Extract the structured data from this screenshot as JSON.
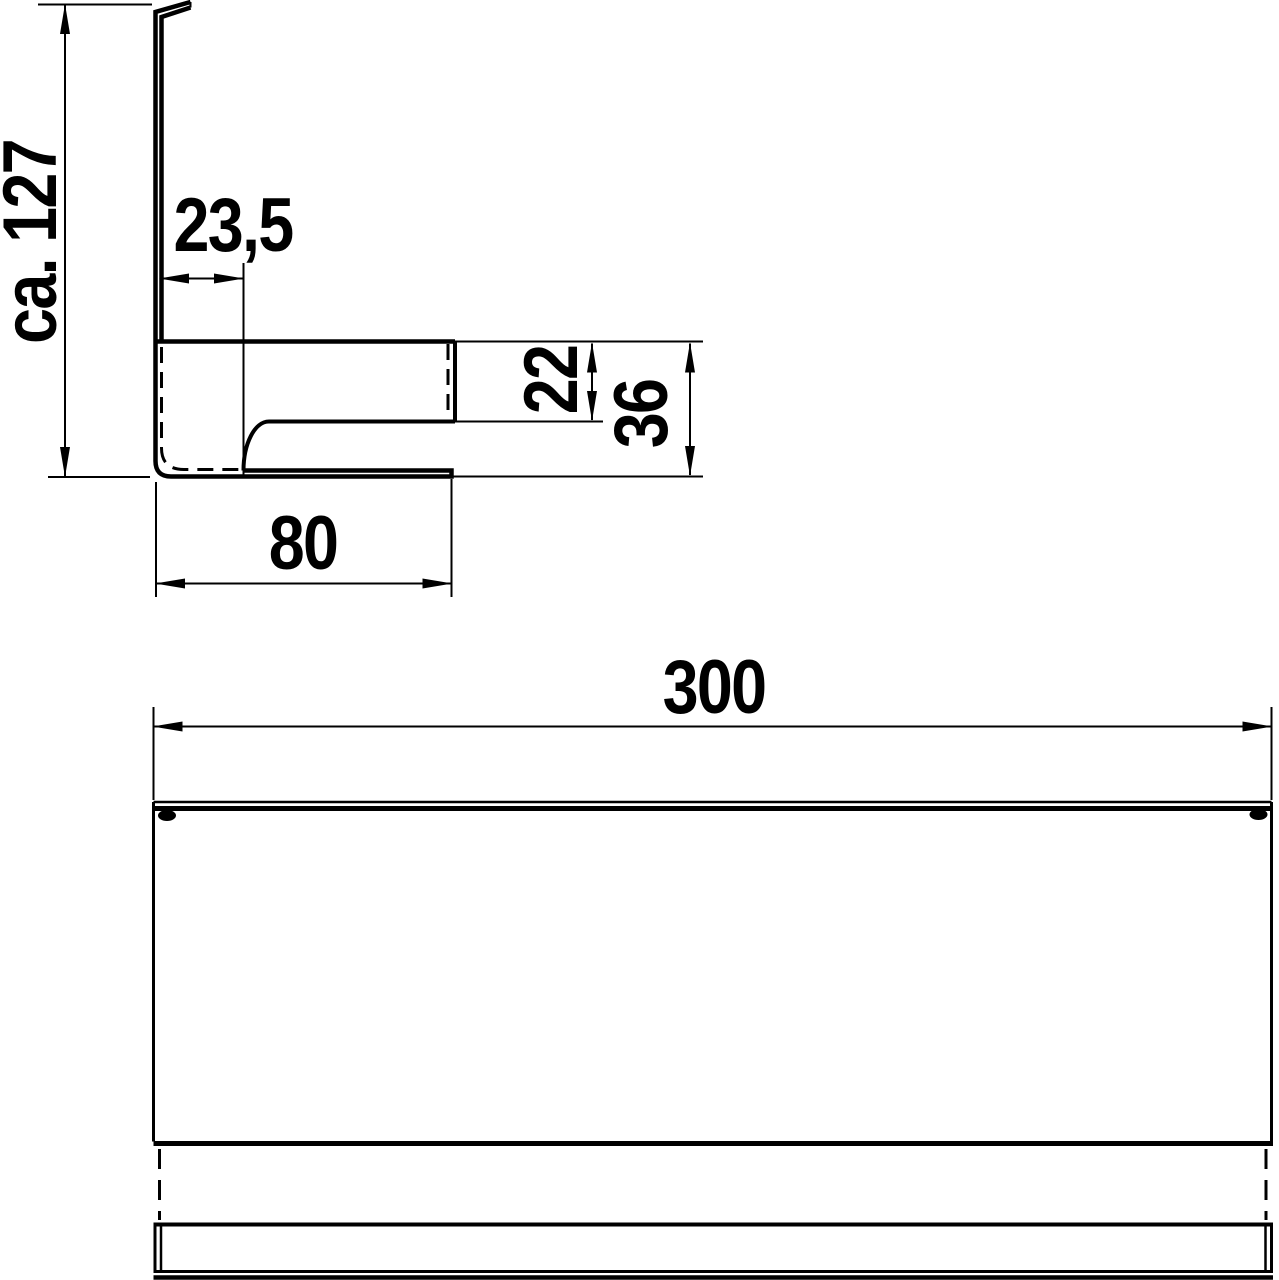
{
  "drawing": {
    "type": "technical-dimension-drawing",
    "colors": {
      "line": "#000000",
      "background": "#ffffff"
    },
    "views": {
      "side": {
        "name": "side profile view"
      },
      "front": {
        "name": "front elevation view"
      }
    }
  },
  "dimensions": {
    "overall_height": {
      "label": "ca. 127"
    },
    "top_offset": {
      "label": "23,5"
    },
    "slot_height": {
      "label": "22"
    },
    "front_height": {
      "label": "36"
    },
    "depth": {
      "label": "80"
    },
    "width": {
      "label": "300"
    }
  }
}
